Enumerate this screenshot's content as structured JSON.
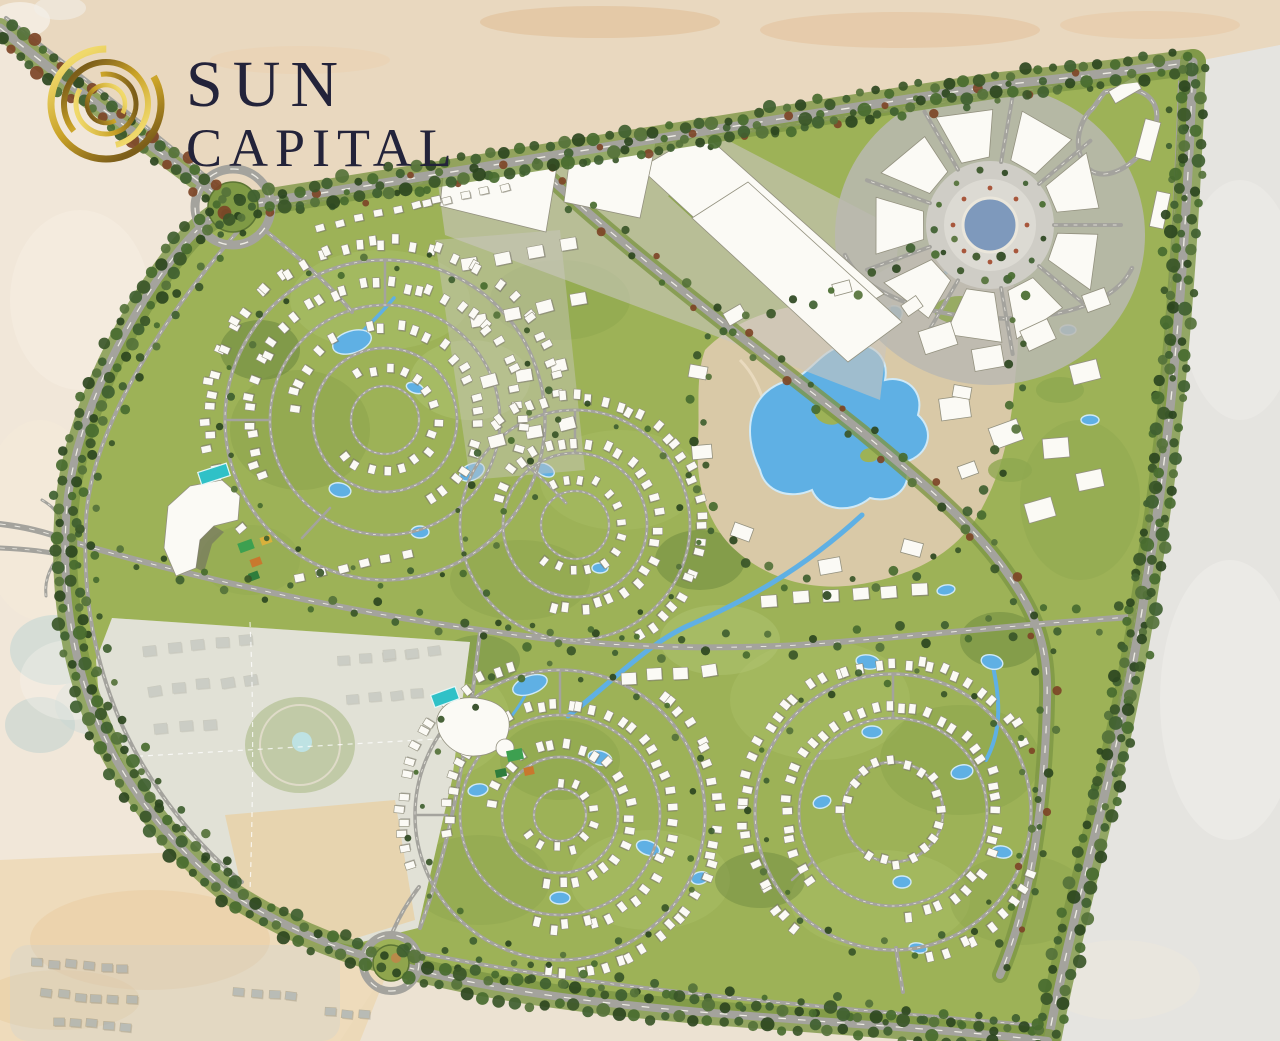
{
  "page": {
    "title": "Sun Capital — Master Plan"
  },
  "logo": {
    "line1": "SUN",
    "line2": "CAPITAL"
  },
  "palette": {
    "ink": "#23233a",
    "gold1": "#f0d96b",
    "gold2": "#c9a227",
    "gold3": "#7c5e1a",
    "desert_base": "#ece2d2",
    "desert_left": "#f3e9db",
    "desert_top": "#e7cfae",
    "desert_right": "#e5e4e0",
    "desert_bl": "#ecd3a7",
    "site_green": "#9db257",
    "belt_green": "#7d9645",
    "road_grey": "#a4a39d",
    "road_dash": "#f6f4ec",
    "water_blue": "#5fb0e4",
    "water_edge": "#cfe9f7",
    "pool_teal": "#2fc1c7",
    "sand": "#d9c9a7",
    "trail": "#ecdfc4",
    "building_white": "#fbfaf5",
    "building_edge": "#93917f",
    "plaza_blue": "#7e99bc",
    "paving": "#c9c7c0",
    "court_green": "#3da050",
    "court_orange": "#c8782e",
    "court_yellow": "#d8b13c",
    "ghost_roof": "#989d96",
    "ghost_hood": "#8fa3b3"
  },
  "map": {
    "regions": [
      "entry-boulevard",
      "north-commercial-district",
      "central-plaza",
      "lakes-park",
      "hotel-resort",
      "clubhouse",
      "residential-neighborhoods",
      "existing-development",
      "north-roundabout",
      "south-roundabout"
    ]
  }
}
